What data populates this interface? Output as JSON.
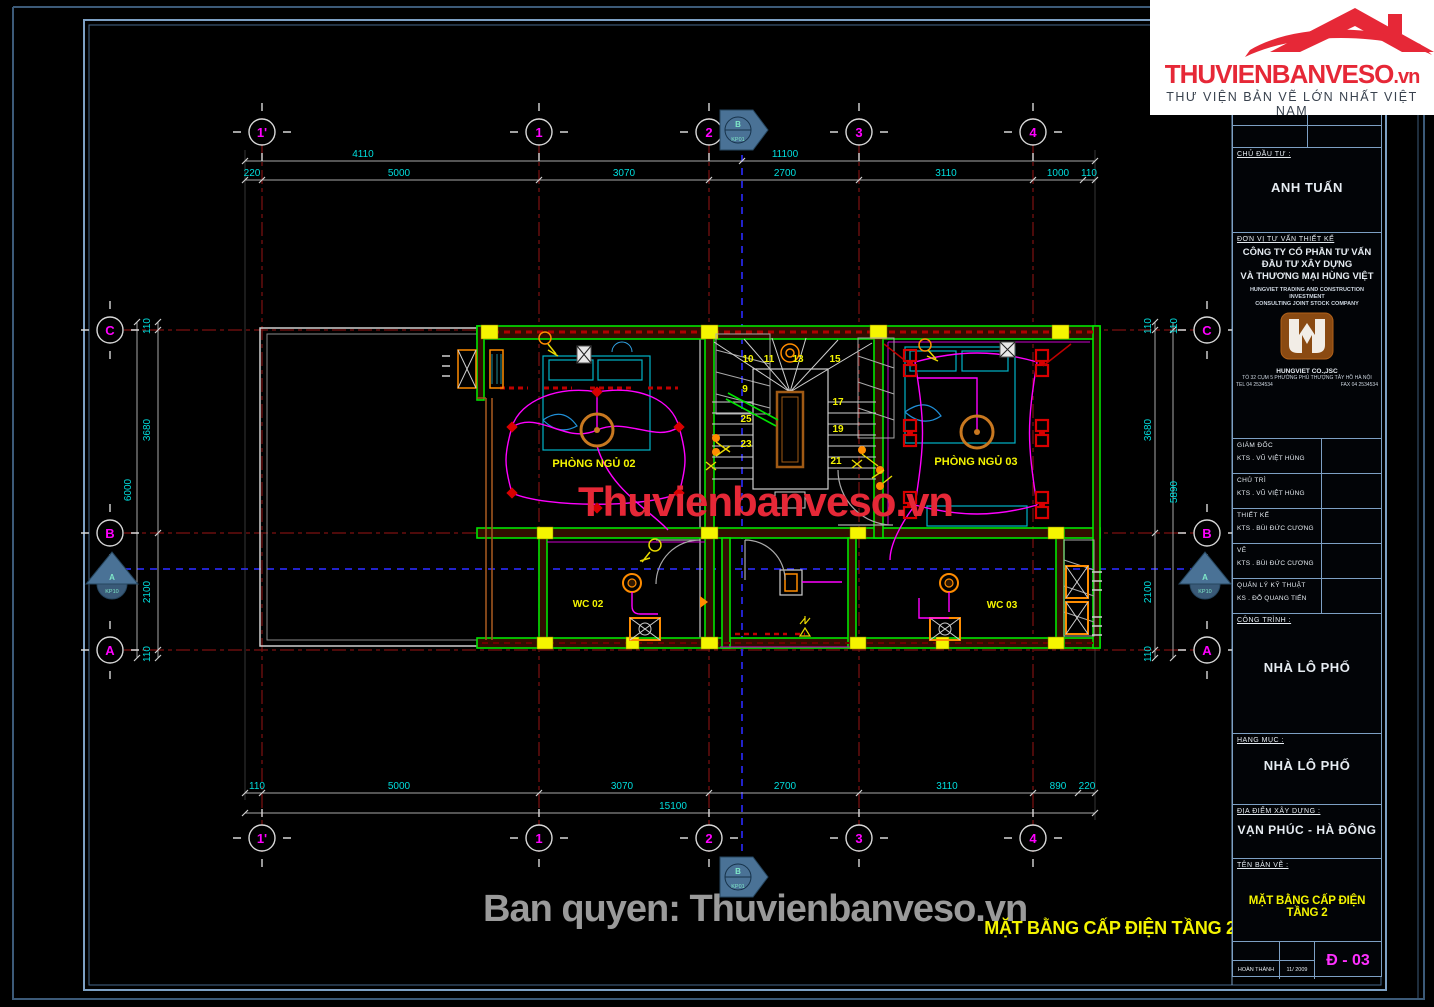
{
  "brand": {
    "logo_text": "THUVIENBANVESO",
    "logo_tld": ".vn",
    "slogan": "THƯ VIỆN BẢN VẼ LỚN NHẤT VIỆT NAM",
    "center_watermark": "Thuvienbanveso.vn",
    "copyright": "Ban quyen: Thuvienbanveso.vn"
  },
  "drawing": {
    "caption": "MẶT BẰNG CẤP ĐIỆN TẦNG 2",
    "grid_columns": [
      "1'",
      "1",
      "2",
      "3",
      "4"
    ],
    "grid_rows": [
      "C",
      "B",
      "A"
    ],
    "markers": {
      "top_label": "B",
      "top_ref": "KP01",
      "bottom_label": "B",
      "bottom_ref": "KP01",
      "left_label": "A",
      "left_ref": "KP10",
      "right_label": "A",
      "right_ref": "KP10"
    },
    "rooms": [
      "PHÒNG NGỦ 02",
      "PHÒNG NGỦ 03",
      "WC 02",
      "WC 03"
    ],
    "stair_numbers": [
      "10",
      "11",
      "13",
      "15",
      "9",
      "17",
      "25",
      "19",
      "23",
      "21"
    ],
    "dimensions": {
      "top_overall": [
        "4110",
        "11100"
      ],
      "top_segments": [
        "220",
        "5000",
        "3070",
        "2700",
        "3110",
        "1000",
        "110"
      ],
      "bottom_segments": [
        "110",
        "5000",
        "3070",
        "2700",
        "3110",
        "890",
        "220"
      ],
      "bottom_overall": "15100",
      "left": [
        "110",
        "3680",
        "2100",
        "110"
      ],
      "left_overall": "6000",
      "right": [
        "110",
        "110",
        "3680",
        "2100",
        "110"
      ],
      "right_overall": "5890"
    }
  },
  "title_block": {
    "investor_label": "CHỦ ĐẦU TƯ :",
    "investor": "ANH TUẤN",
    "consultant_label": "ĐƠN VỊ TƯ VẤN THIẾT KẾ",
    "company_line1": "CÔNG TY CỔ PHẦN TƯ VẤN",
    "company_line2": "ĐẦU TƯ XÂY DỰNG",
    "company_line3": "VÀ THƯƠNG MẠI HÙNG VIỆT",
    "company_en1": "HUNGVIET TRADING AND CONSTRUCTION INVESTMENT",
    "company_en2": "CONSULTING JOINT STOCK COMPANY",
    "company_short": "HUNGVIET CO.,JSC",
    "company_addr": "TỔ 32 CỤM 5 PHƯỜNG PHÚ THƯỢNG TÂY HỒ HÀ NỘI",
    "company_tel": "TEL 04 2534534",
    "company_fax": "FAX 04 2534534",
    "roles": [
      {
        "title": "GIÁM ĐỐC",
        "name": "KTS . VŨ VIỆT HÙNG"
      },
      {
        "title": "CHỦ TRÌ",
        "name": "KTS . VŨ VIỆT HÙNG"
      },
      {
        "title": "THIẾT KẾ",
        "name": "KTS . BÙI ĐỨC CƯƠNG"
      },
      {
        "title": "VẼ",
        "name": "KTS . BÙI ĐỨC CƯƠNG"
      },
      {
        "title": "QUẢN LÝ KỸ THUẬT",
        "name": "KS . ĐỖ QUANG TIẾN"
      }
    ],
    "project_label": "CÔNG TRÌNH :",
    "project": "NHÀ LÔ PHỐ",
    "category_label": "HẠNG MỤC :",
    "category": "NHÀ LÔ PHỐ",
    "location_label": "ĐỊA ĐIỂM XÂY DỰNG :",
    "location": "VẠN PHÚC - HÀ ĐÔNG",
    "sheet_label": "TÊN BẢN VẼ :",
    "sheet_title": "MẶT BẰNG CẤP ĐIỆN TẦNG 2",
    "completed_label": "HOÀN THÀNH",
    "completed_date": "11/ 2009",
    "sheet_number": "Đ - 03"
  }
}
